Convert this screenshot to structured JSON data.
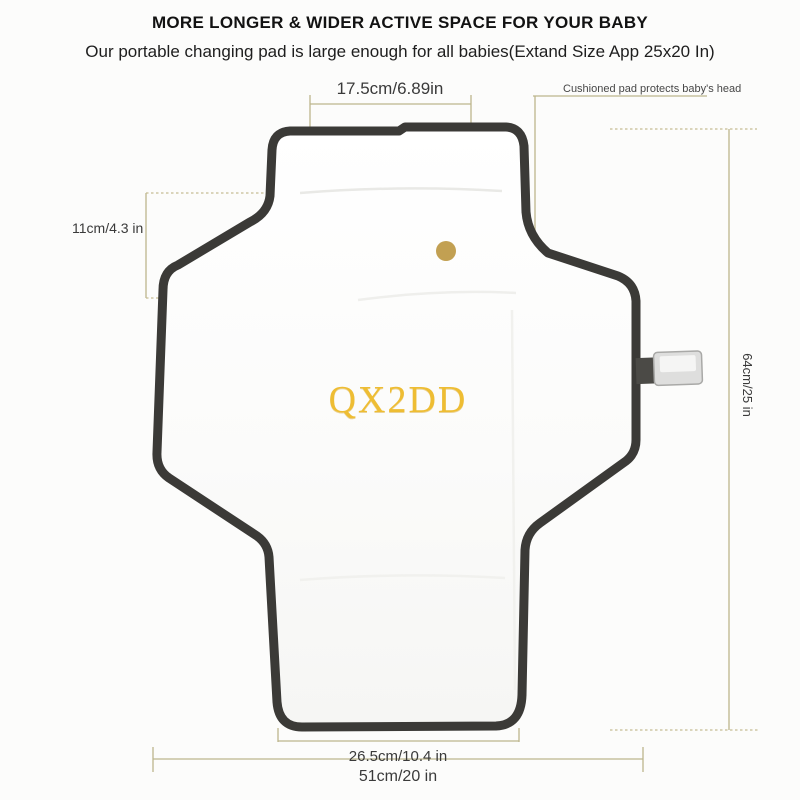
{
  "header": {
    "title": "MORE LONGER & WIDER ACTIVE SPACE FOR YOUR BABY",
    "subtitle": "Our portable changing pad is large enough for all babies(Extand Size App 25x20 In)"
  },
  "annotations": {
    "pillow_width": "17.5cm/6.89in",
    "head_note": "Cushioned pad protects baby's head",
    "flap_height": "11cm/4.3 in",
    "total_length": "64cm/25 in",
    "bottom_width": "26.5cm/10.4 in",
    "total_width": "51cm/20 in"
  },
  "watermark": "QX2DD",
  "icons": {
    "snap_dot": "snap-button-dot",
    "buckle": "strap-buckle"
  },
  "colors": {
    "pad_border": "#3b3a37",
    "pad_fill": "#fdfdfc",
    "dimension_line": "#bdb68c",
    "snap_dot": "#c2a052",
    "watermark_gold": "#eebd33",
    "dim_text": "#3a3a3a",
    "buckle_body": "#dededd",
    "strap": "#4b4a46"
  }
}
